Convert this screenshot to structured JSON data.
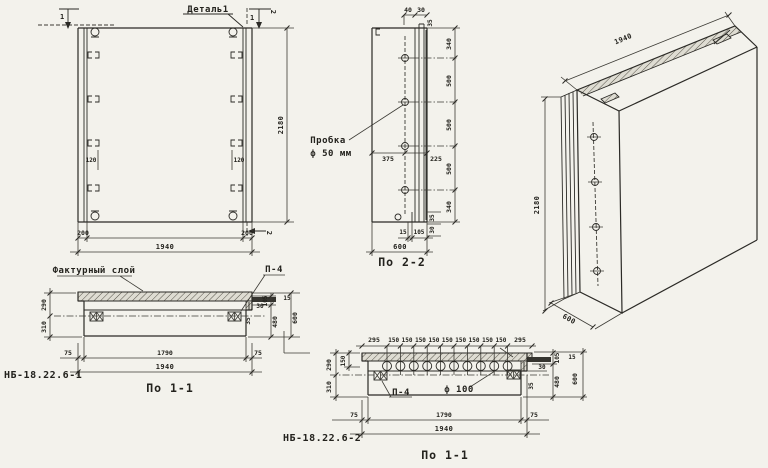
{
  "front_view": {
    "detail_label": "Деталь1",
    "mark_1_left": "1",
    "mark_1_right": "1",
    "mark_2_top": "2",
    "mark_2_bottom": "2",
    "dim_height": "2180",
    "dim_width": "1940",
    "dim_edge_left": "200",
    "dim_edge_right": "200",
    "dim_anchor_left": "120",
    "dim_anchor_right": "120"
  },
  "section_2_2": {
    "title": "По 2-2",
    "plug_label_1": "Пробка",
    "plug_label_2": "ф 50 мм",
    "dim_top_40": "40",
    "dim_top_30": "30",
    "dim_top_35": "35",
    "dims_right": [
      "340",
      "500",
      "500",
      "500",
      "340"
    ],
    "dim_375": "375",
    "dim_225": "225",
    "dim_bot_15": "15",
    "dim_bot_105": "105",
    "dim_bot_600": "600",
    "dim_side_35": "35",
    "dim_side_30": "30"
  },
  "iso_view": {
    "dim_width": "1940",
    "dim_height": "2180",
    "dim_depth": "600"
  },
  "section_1_1_a": {
    "title": "По 1-1",
    "part_mark": "НБ-18.22.6-1",
    "texture_label": "Фактурный слой",
    "plate_label": "П-4",
    "dim_290": "290",
    "dim_310": "310",
    "dim_30": "30",
    "dim_35": "35",
    "dim_15": "15",
    "dim_105": "105",
    "dim_480": "480",
    "dim_600": "600",
    "dim_75_left": "75",
    "dim_1790": "1790",
    "dim_75_right": "75",
    "dim_1940": "1940"
  },
  "section_1_1_b": {
    "title": "По 1-1",
    "part_mark": "НБ-18.22.6-2",
    "plate_label": "П-4",
    "hole_label": "ф 100",
    "dim_295_left": "295",
    "dims_150": [
      "150",
      "150",
      "150",
      "150",
      "150",
      "150",
      "150",
      "150",
      "150"
    ],
    "dim_295_right": "295",
    "dim_150_side": "150",
    "dim_290": "290",
    "dim_310": "310",
    "dim_30": "30",
    "dim_35": "35",
    "dim_15": "15",
    "dim_105": "105",
    "dim_480": "480",
    "dim_600": "600",
    "dim_75_left": "75",
    "dim_1790": "1790",
    "dim_75_right": "75",
    "dim_1940": "1940"
  }
}
